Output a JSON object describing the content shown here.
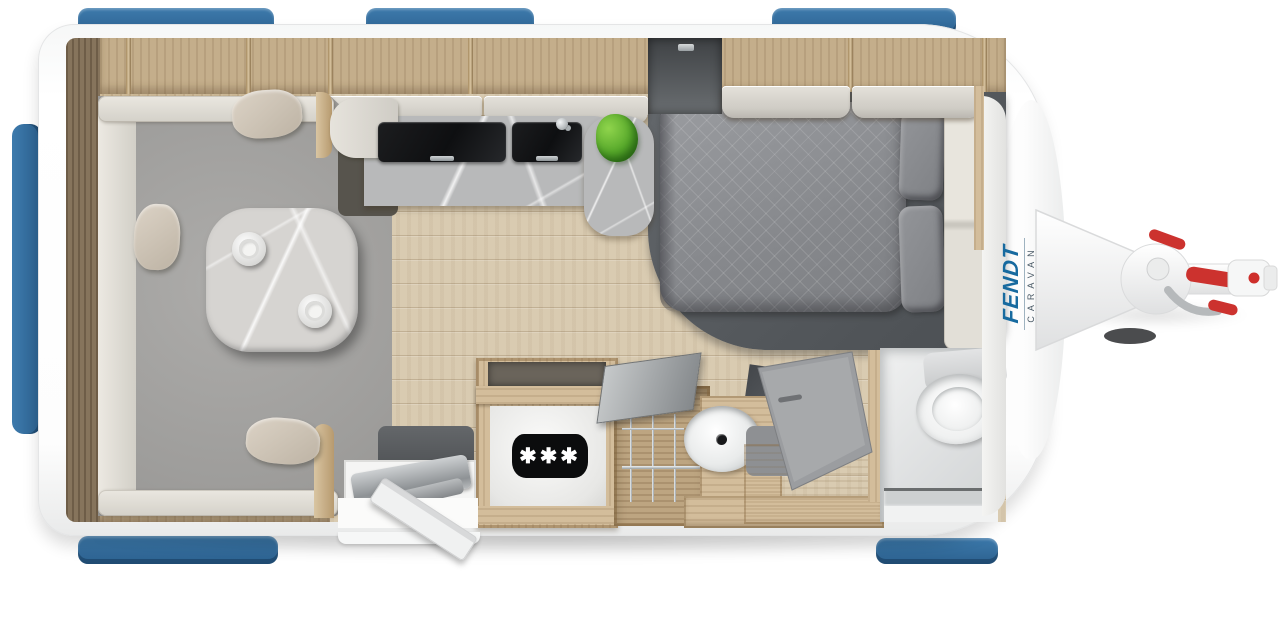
{
  "logo": {
    "brand": "FENDT",
    "sub": "CARAVAN"
  },
  "fridge": {
    "badge": "✱✱✱"
  },
  "colors": {
    "window_blue": "#2f6b9f",
    "shell_white": "#fdfdfd",
    "wood_light": "#d3bd9b",
    "wood_wall": "#cdb997",
    "wall_dark_wood": "#86745c",
    "floor_wood": "#d9cbb1",
    "sofa_gray": "#a3a2a0",
    "upholstery_cream": "#e6e3db",
    "pillow_beige": "#cfc6b6",
    "table_marble": "#d6d4d1",
    "counter_marble": "#b8b9ba",
    "glass_cover_black": "#141517",
    "bed_duvet_gray": "#8f9194",
    "bed_base_dark": "#54585c",
    "plant_green": "#56a82a",
    "accent_red": "#cc322e",
    "logo_blue": "#176a9f",
    "logo_sub_gray": "#4a5a66",
    "fridge_badge_black": "#0b0c0d"
  }
}
